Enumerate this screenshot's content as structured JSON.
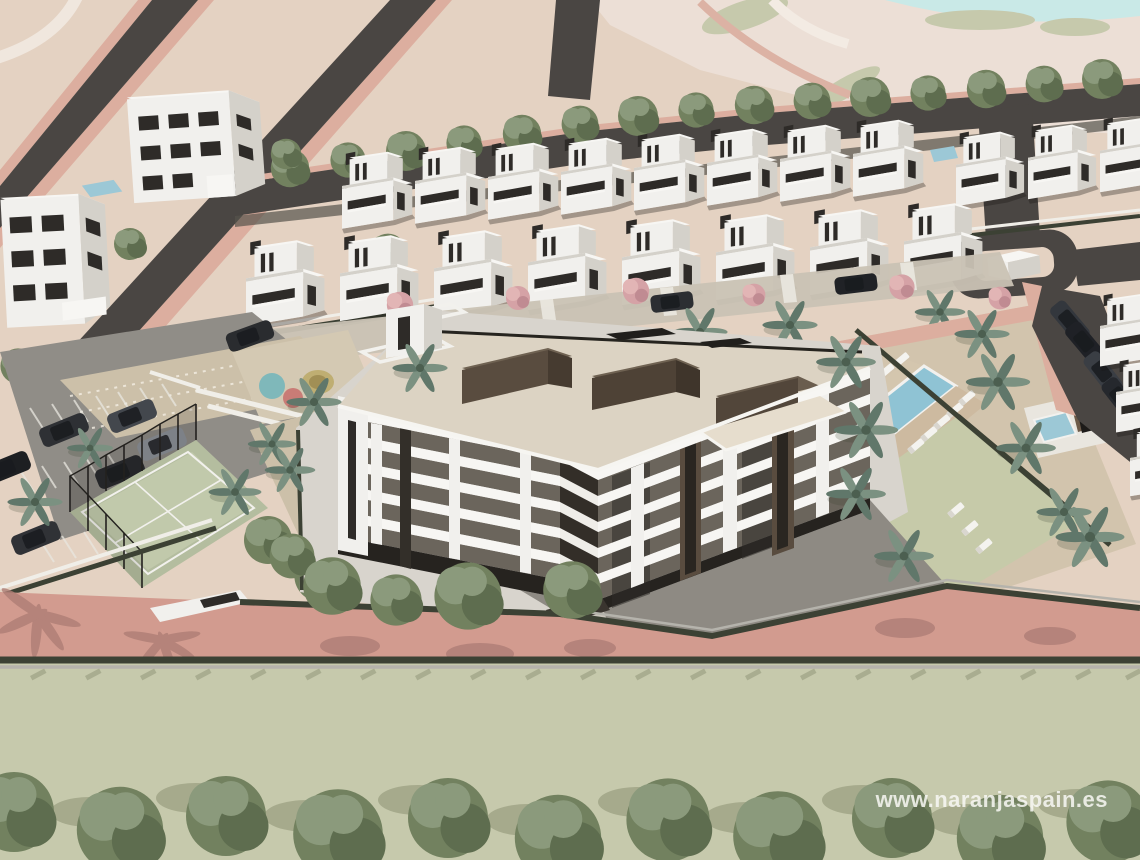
{
  "meta": {
    "description": "Aerial 3D architectural render of a coastal residential development: a central 5-storey apartment block with cream roof terraces and dark-brown penthouse volumes, surrounded by rows of white modern villas, a communal swimming pool with sun loungers and lawn, a padel court, playground, parking areas, palm trees and flowering pink trees, bounded by a salmon access road and a green field."
  },
  "watermark": {
    "text": "www.naranjaspain.es"
  },
  "colors": {
    "terrain-beige": "#e4d2c2",
    "terrain-pale": "#ecdfd6",
    "road-dark": "#4a4643",
    "road-pink": "#dcae9f",
    "road-salmon": "#d29b8f",
    "field-sage": "#c6c9ac",
    "lake-cyan": "#c9e9e7",
    "pool-blue": "#8fc3d4",
    "building-white": "#f1f0ed",
    "building-shade": "#d4d1ca",
    "roof-cream": "#dcd3c3",
    "penthouse-brown": "#594c3f",
    "window-dark": "#2e2b28",
    "tree-green": "#72815f",
    "palm-green": "#7b9181",
    "flower-pink": "#d5a2a6",
    "hedge-dark": "#3c4134",
    "lawn-green": "#c6caa9",
    "asphalt-gray": "#908d87",
    "gravel-tan": "#ccc0a9"
  },
  "scene": {
    "central_building": "5-storey apartment block, white balcony bands, taupe window bands, dark-brown rooftop penthouses",
    "villa_rows": {
      "back_row": 8,
      "middle_row": 8,
      "hill_cluster": 3,
      "street_side": 3
    },
    "amenities": [
      "swimming pool",
      "sun loungers",
      "lawn",
      "padel court",
      "playground",
      "parking",
      "roundabout"
    ],
    "vegetation": [
      "round trees",
      "palm trees",
      "pink flowering trees",
      "hedges"
    ],
    "vehicles": {
      "parking_cars": 7,
      "lane_cars": 2,
      "street_cars": 4
    }
  }
}
